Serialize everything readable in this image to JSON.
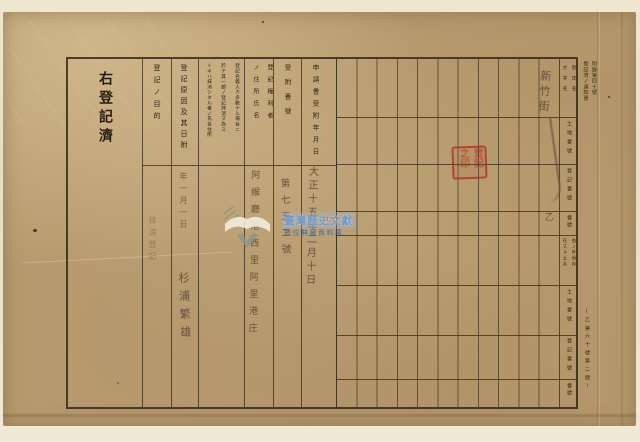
{
  "page": {
    "left_stamp": "右登記濟",
    "margin": {
      "form_number": "附錄第四十號",
      "form_title": "登記濟ノ通知書",
      "bottom_note": "(乙第六十號第二面)"
    },
    "columns": {
      "purpose": {
        "header": "登記ノ目的",
        "entry": "抹消登記"
      },
      "cause": {
        "header": "登記原因及其日附",
        "entry": "年一月一日",
        "signature": "杉浦繁雄"
      },
      "note": {
        "line1": "登記名義人カ多數ナル場合ニ",
        "line2": "於テ其一部ノ登記抹消ヲ為ス",
        "line3": "トキハ抹消シタル者ノ氏名住所"
      },
      "rights_holder": {
        "line1": "登記権利者",
        "line2": "ノ住所氏名",
        "entry": "阿緱廳港西里阿里港庄"
      },
      "receipt_no": {
        "header": "受附番號",
        "entry": "第七五二號"
      },
      "application_date": {
        "header": "申請書受附年月日",
        "entry": "大正十五年二月十日"
      }
    },
    "grid": {
      "band1": {
        "place_r": "街庄名",
        "place_l": "大字名",
        "land_no": "土地番號",
        "reg_no": "登記番號",
        "no": "番號"
      },
      "band2": {
        "place_r": "右ノ外尚存",
        "place_l": "在スル土名",
        "land_no": "土地番號",
        "reg_no": "登記番號",
        "no": "番號"
      },
      "annotation_top": "新竹街",
      "annotation_mark": "乙"
    },
    "seal": {
      "line1": "登記",
      "line2": "之印"
    },
    "watermark": {
      "line1": "臺灣歷史文獻",
      "line2": "數位典藏資料庫"
    }
  }
}
